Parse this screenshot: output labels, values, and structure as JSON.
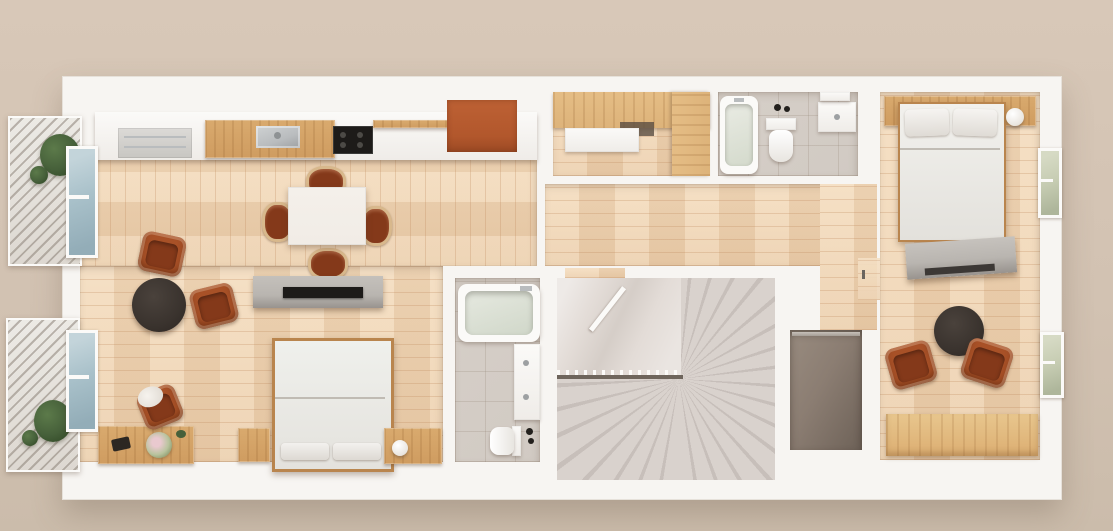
{
  "scene": {
    "type": "3d-floorplan-top-down-render",
    "description": "Photorealistic top-down 3D render of a narrow apartment floor plan on a beige backdrop; no visible text in the image",
    "visible_text": "none"
  },
  "palette": {
    "bgTop": "#d8c8b8",
    "bgBottom": "#cbbcab",
    "wall": "#f7f5f2",
    "wallEdge": "#e6e1da",
    "wood": "#eccfac",
    "woodHi": "#f4dcbd",
    "woodGap": "#cfa478",
    "oak": "#d9aa6e",
    "oakDeep": "#b9854e",
    "closetOak": "#ddb37a",
    "terracotta": "#a85127",
    "terracottaDeep": "#84391a",
    "wicker": "#d8b88c",
    "cream": "#f1ece6",
    "concrete": "#b9b5b0",
    "concreteDeep": "#98938e",
    "black": "#1d1b19",
    "darkwood": "#3a332e",
    "tile": "#d1cac3",
    "tileLine": "#bdb4ab",
    "stair": "#d9d2cd",
    "stairAlt": "#c7bfba",
    "landing": "#e3dcd7",
    "stairEdge": "#6e655c",
    "stone": "#8b7d72",
    "stoneDeep": "#70645a",
    "glassBlue": "#a9c1ca",
    "glassGreen": "#c6ccb2",
    "plant": "#46603a",
    "plantDeep": "#2f4724",
    "orange": "#b2572c",
    "steel": "#b9bcbe",
    "greyAppliance": "#dcdad7",
    "shadowLine": "#8f8173",
    "white": "#fbfaf8"
  },
  "rooms": [
    {
      "id": "living",
      "name": "Open-plan living / dining / kitchen with bed area",
      "furniture": [
        "kitchen counter with grey appliance, steel sink and black cooktop",
        "orange accent panel",
        "white dining table with four terracotta chairs",
        "two terracotta armchairs",
        "round black coffee table",
        "concrete TV console with flat TV",
        "double bed with two pillows",
        "two oak nightstands with ball lamp",
        "oak desk with flowers and desk chair"
      ]
    },
    {
      "id": "walk_in_closet",
      "name": "Walk-in closet",
      "furniture": [
        "oak wardrobe run",
        "oak side wardrobe",
        "white built-in desk"
      ]
    },
    {
      "id": "bathroom_top",
      "name": "Small bathroom (top)",
      "furniture": [
        "bathtub",
        "toilet",
        "white vanity with sink",
        "wall shelf"
      ]
    },
    {
      "id": "bedroom_right",
      "name": "Bedroom (right)",
      "furniture": [
        "oak headboard shelf",
        "double bed with two pillows",
        "ball lamp",
        "concrete dresser",
        "round dark side table",
        "two terracotta armchairs",
        "oak bench"
      ]
    },
    {
      "id": "bathroom_main",
      "name": "Main bathroom (center)",
      "furniture": [
        "bathtub",
        "vanity with two sinks",
        "toilet"
      ]
    },
    {
      "id": "staircase",
      "name": "Winder staircase with landing and railing",
      "furniture": []
    },
    {
      "id": "niche",
      "name": "Dark stone storage niche with rail",
      "furniture": []
    },
    {
      "id": "hallway",
      "name": "Hallway",
      "furniture": []
    },
    {
      "id": "balcony_upper",
      "name": "Balcony (upper left)",
      "furniture": [
        "plant"
      ]
    },
    {
      "id": "balcony_lower",
      "name": "Balcony (lower left)",
      "furniture": [
        "plant"
      ]
    }
  ]
}
